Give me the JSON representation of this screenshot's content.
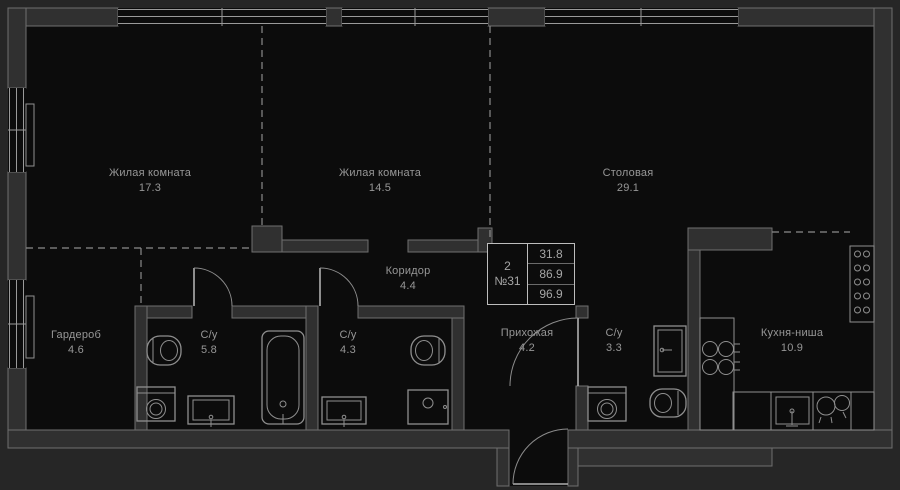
{
  "stamp": {
    "rooms_count": "2",
    "apartment_number": "№31",
    "areas": [
      "31.8",
      "86.9",
      "96.9"
    ]
  },
  "rooms": [
    {
      "id": "living-room-1",
      "name": "Жилая комната",
      "area": "17.3"
    },
    {
      "id": "living-room-2",
      "name": "Жилая комната",
      "area": "14.5"
    },
    {
      "id": "dining-room",
      "name": "Столовая",
      "area": "29.1"
    },
    {
      "id": "corridor",
      "name": "Коридор",
      "area": "4.4"
    },
    {
      "id": "wardrobe",
      "name": "Гардероб",
      "area": "4.6"
    },
    {
      "id": "bathroom-1",
      "name": "С/у",
      "area": "5.8"
    },
    {
      "id": "bathroom-2",
      "name": "С/у",
      "area": "4.3"
    },
    {
      "id": "hallway",
      "name": "Прихожая",
      "area": "4.2"
    },
    {
      "id": "bathroom-3",
      "name": "С/у",
      "area": "3.3"
    },
    {
      "id": "kitchen-niche",
      "name": "Кухня-ниша",
      "area": "10.9"
    }
  ],
  "colors": {
    "page_background": "#262626",
    "floor": "#0c0c0c",
    "wall_fill": "#303030",
    "line": "#8f8f8f",
    "label_text": "#979797",
    "stamp_border": "#bdbdbd"
  }
}
